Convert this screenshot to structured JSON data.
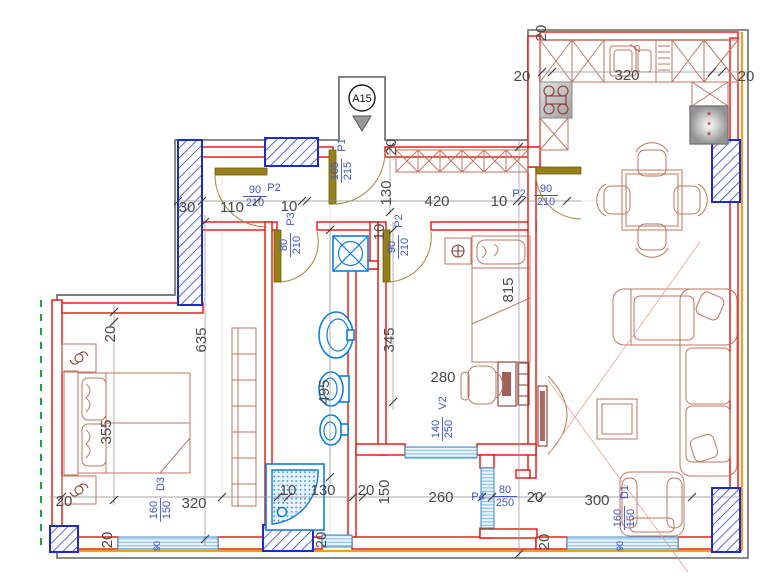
{
  "unit": {
    "label": "A15"
  },
  "doors": {
    "p1": {
      "code": "P1",
      "w": "105",
      "h": "215"
    },
    "p2_corridor": {
      "code": "P2",
      "w": "90",
      "h": "210"
    },
    "p2_living": {
      "code": "P2",
      "w": "90",
      "h": "210"
    },
    "p2_bedroom2": {
      "code": "P2",
      "w": "90",
      "h": "210"
    },
    "p3_bathroom": {
      "code": "P3",
      "w": "80",
      "h": "210"
    },
    "p4": {
      "code": "P4",
      "w": "80",
      "h": "250"
    },
    "v2": {
      "code": "V2",
      "w": "140",
      "h": "250"
    }
  },
  "windows": {
    "d3": {
      "code": "D3",
      "w": "160",
      "h": "150",
      "sill": "90"
    },
    "d1": {
      "code": "D1",
      "w": "160",
      "h": "150",
      "sill": "90"
    }
  },
  "dims": {
    "hall_wall": "30",
    "hall_seg": "110",
    "hall_gap1": "10",
    "hall_width": "130",
    "hall_len": "420",
    "hall_gap2": "10",
    "entry_wall": "20",
    "kitchen_wall_top": "20",
    "kitchen_left": "20",
    "kitchen_run": "320",
    "kitchen_right": "20",
    "living_len": "815",
    "corridor_len": "635",
    "bedroom_wall": "20",
    "bed_width": "355",
    "bedroom_len": "320",
    "bedroom_wall_left": "20",
    "bedroom_win_jamb": "20",
    "bedroom2_len": "345",
    "bedroom2_width": "280",
    "bedroom2_jamb": "10",
    "bath_len": "495",
    "bath_jamb": "10",
    "shower_width": "130",
    "bath_wall": "20",
    "bath_win_jamb": "20",
    "balcony_depth": "150",
    "balcony_width": "260",
    "living_jamb": "20",
    "living_width": "300",
    "living_win_jamb": "20"
  },
  "colors": {
    "wall_new": "#e8100a",
    "wall_existing": "#7a7a7a",
    "demolition_blue": "#1c2bd0",
    "fixture_blue": "#0d7fe0",
    "furniture": "#c0765f",
    "door_leaf": "#96801c",
    "accent_orange": "#eea120",
    "accent_green": "#20a13c",
    "label_blue": "#3f56c6"
  }
}
